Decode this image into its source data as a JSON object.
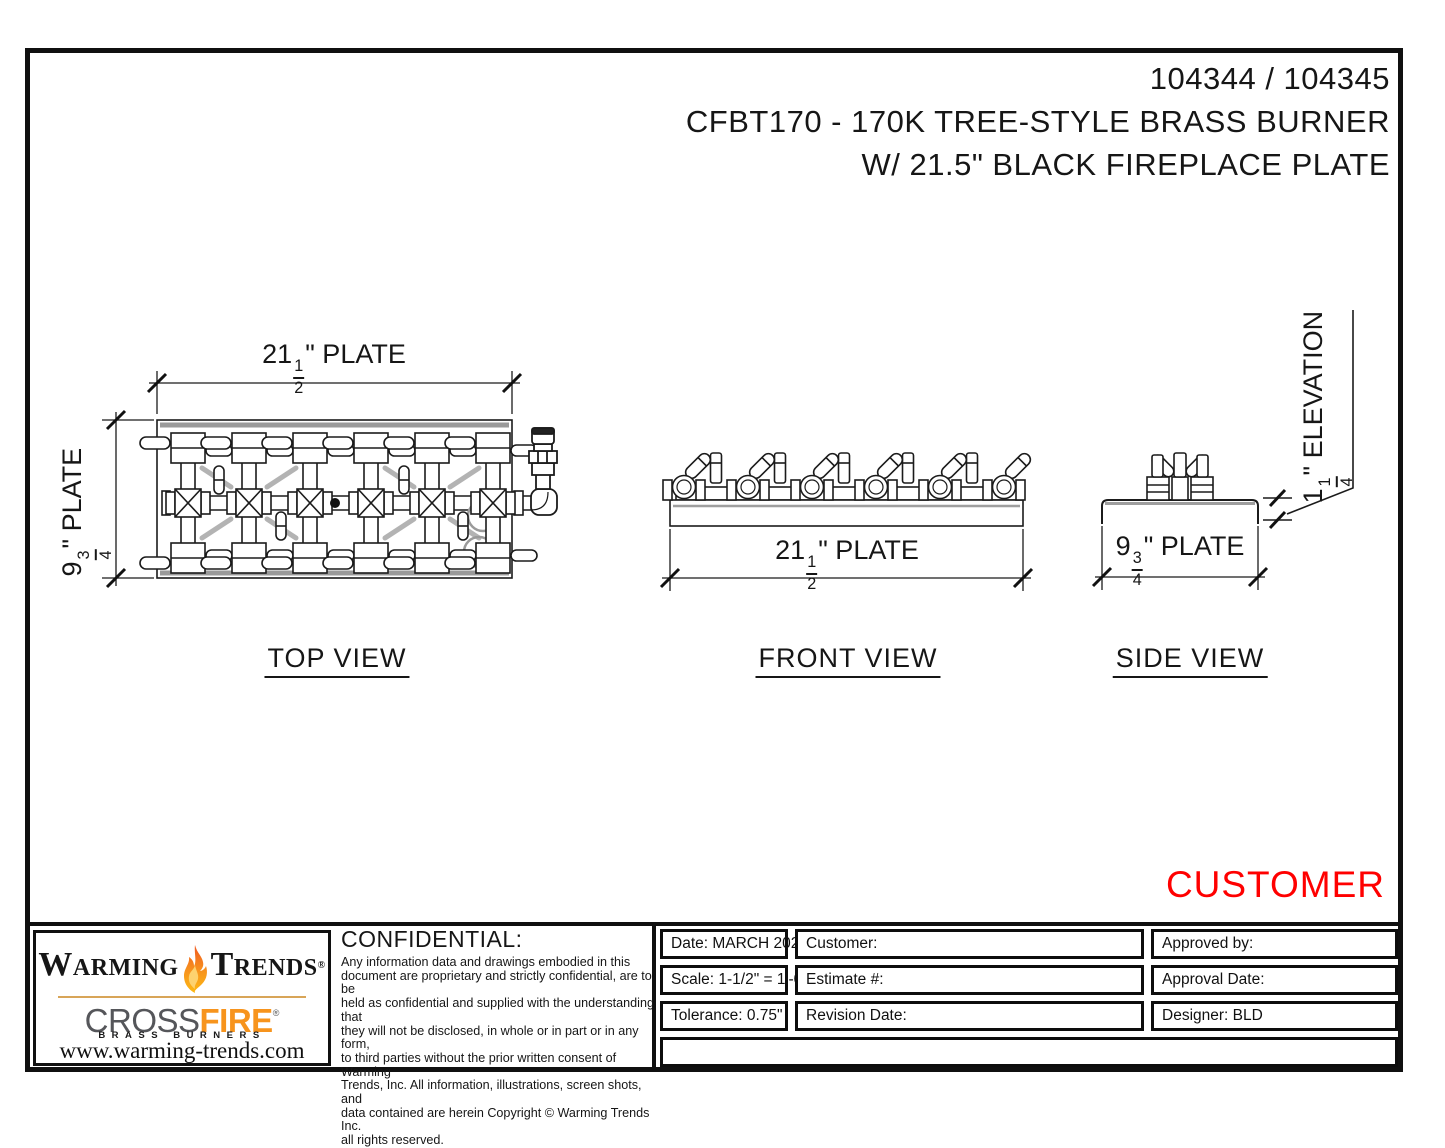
{
  "header": {
    "part_numbers": "104344 / 104345",
    "title_line1": "CFBT170 - 170K TREE-STYLE BRASS BURNER",
    "title_line2": "W/ 21.5\" BLACK FIREPLACE PLATE"
  },
  "stamp": {
    "text": "CUSTOMER",
    "color": "#ff0000"
  },
  "views": {
    "top": {
      "label": "TOP VIEW",
      "width_dim": {
        "whole": "21",
        "num": "1",
        "den": "2",
        "suffix": "\" PLATE"
      },
      "depth_dim": {
        "whole": "9",
        "num": "3",
        "den": "4",
        "suffix": "\" PLATE"
      }
    },
    "front": {
      "label": "FRONT VIEW",
      "width_dim": {
        "whole": "21",
        "num": "1",
        "den": "2",
        "suffix": "\" PLATE"
      }
    },
    "side": {
      "label": "SIDE VIEW",
      "width_dim": {
        "whole": "9",
        "num": "3",
        "den": "4",
        "suffix": "\" PLATE"
      },
      "elevation_dim": {
        "whole": "1",
        "num": "1",
        "den": "4",
        "suffix": "\" ELEVATION"
      }
    }
  },
  "title_block": {
    "logo": {
      "brand_left": "Warming",
      "brand_right": "Trends",
      "brand_reg": "®",
      "product_left": "CROSS",
      "product_right": "FIRE",
      "product_reg": "®",
      "tagline": "BRASS BURNERS",
      "website": "www.warming-trends.com"
    },
    "confidential": {
      "heading": "CONFIDENTIAL:",
      "lines": [
        "Any information data and drawings embodied in this",
        "document are proprietary and strictly confidential, are to be",
        "held as confidential and supplied with the understanding that",
        "they will not be disclosed, in whole or in part or in any form,",
        "to third parties without the prior written consent of Warming",
        "Trends, Inc. All information, illustrations, screen shots, and",
        "data contained are herein Copyright © Warming Trends Inc.",
        "all rights reserved."
      ]
    },
    "fields": {
      "date": "Date: MARCH 2024",
      "scale": "Scale: 1-1/2\" = 1'-0\"",
      "tolerance": "Tolerance: 0.75\"",
      "customer": "Customer:",
      "estimate": "Estimate #:",
      "revision": "Revision Date:",
      "approved_by": "Approved by:",
      "approval_date": "Approval Date:",
      "designer": "Designer: BLD"
    }
  }
}
